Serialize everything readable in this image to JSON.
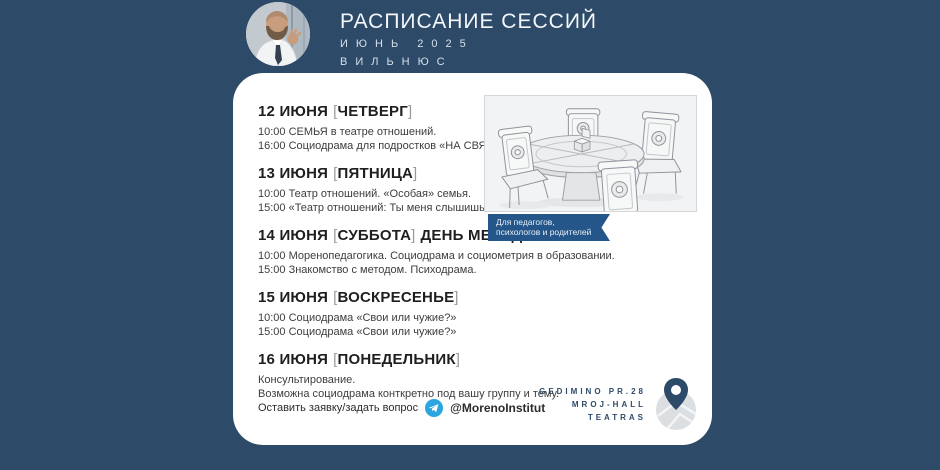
{
  "header": {
    "title": "РАСПИСАНИЕ СЕССИЙ",
    "subtitle_month": "ИЮНЬ 2025",
    "subtitle_city": "ВИЛЬНЮС"
  },
  "ui": {
    "bracket_open": "[",
    "bracket_close": "]"
  },
  "schedule": {
    "entries": [
      {
        "date": "12 ИЮНЯ",
        "day": "ЧЕТВЕРГ",
        "extra": "",
        "lines": [
          "10:00 СЕМЬЯ в театре отношений.",
          "16:00 Социодрама для подростков «НА СВЯЗИ»"
        ]
      },
      {
        "date": "13 ИЮНЯ",
        "day": "ПЯТНИЦА",
        "extra": "",
        "lines": [
          "10:00 Театр отношений. «Особая» семья.",
          "15:00  «Театр отношений: Ты меня слышишь?»"
        ]
      },
      {
        "date": "14 ИЮНЯ",
        "day": "СУББОТА",
        "extra": "ДЕНЬ МЕТОДА",
        "lines": [
          "10:00 Моренопедагогика. Социодрама и социометрия в образовании.",
          "15:00 Знакомство с методом. Психодрама."
        ]
      },
      {
        "date": "15 ИЮНЯ",
        "day": "ВОСКРЕСЕНЬЕ",
        "extra": "",
        "lines": [
          "10:00 Социодрама «Свои или чужие?»",
          "15:00 Социодрама «Свои или чужие?»"
        ]
      },
      {
        "date": "16 ИЮНЯ",
        "day": "ПОНЕДЕЛЬНИК",
        "extra": "",
        "lines": [
          "Консультирование.",
          "Возможна социодрама конткретно под вашу группу и тему."
        ]
      }
    ],
    "badge": "Для педагогов, психологов и родителей"
  },
  "footer": {
    "cta": "Оставить заявку/задать вопрос",
    "telegram_handle": "@MorenoInstitut"
  },
  "location": {
    "line1": "GEDIMINO PR.28",
    "line2": "MROJ-HALL",
    "line3": "TEATRAS"
  },
  "colors": {
    "background": "#2d4a68",
    "card": "#ffffff",
    "badge": "#24568a",
    "telegram_blue": "#2ca5e0",
    "location_text": "#2e4b6b"
  }
}
